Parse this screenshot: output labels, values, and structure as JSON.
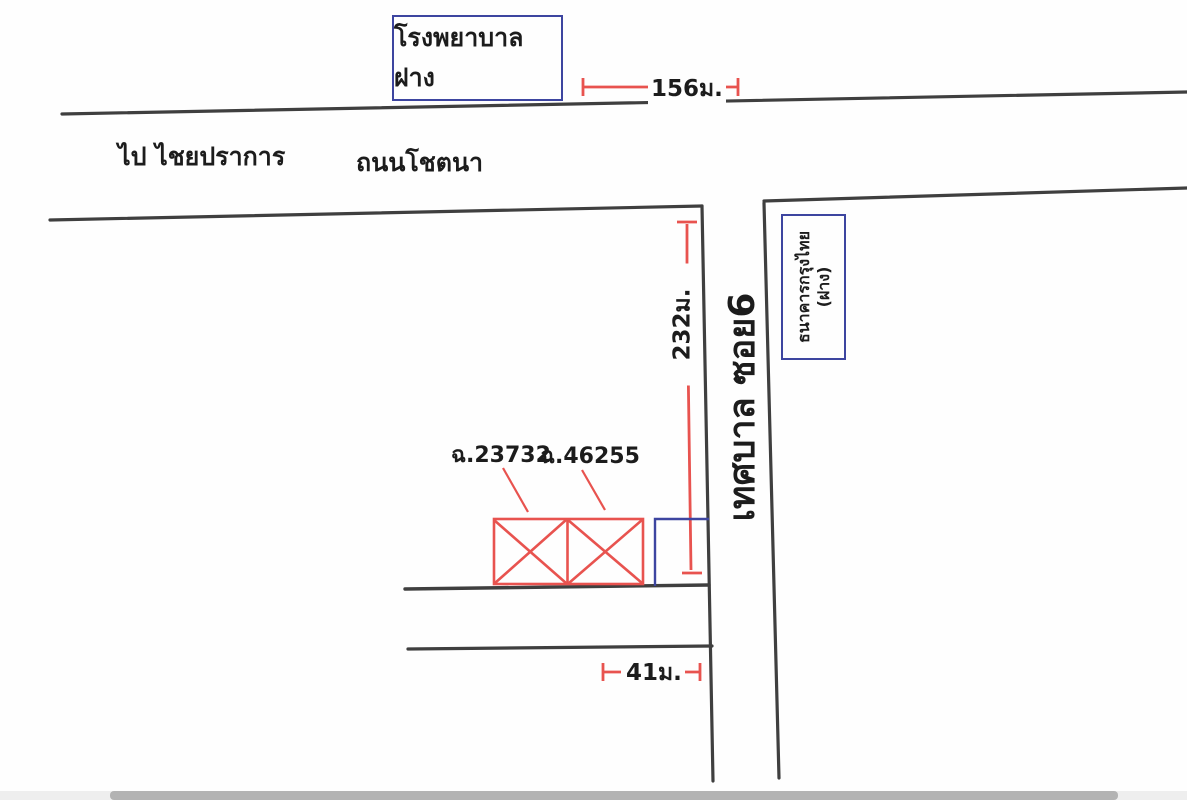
{
  "colors": {
    "ink": "#3f3f3f",
    "red": "#e8534f",
    "blue": "#3d45a0",
    "paper": "#fefefe",
    "scrollbar_track": "#eeeeee",
    "scrollbar_thumb": "#b3b3b3"
  },
  "map": {
    "hospital_label": "โรงพยาบาลฝาง",
    "direction_label": "ไป ไชยปราการ",
    "road_name_label": "ถนนโชตนา",
    "soi_label": "เทศบาล ซอย6",
    "bank_label_line1": "ธนาคารกรุงไทย",
    "bank_label_line2": "(ฝาง)",
    "parcel_labels": [
      "ฉ.23732",
      "ฉ.46255"
    ],
    "dimensions": {
      "hospital_to_soi": "156ม.",
      "road_to_parcel": "232ม.",
      "parcel_frontage": "41ม."
    }
  }
}
